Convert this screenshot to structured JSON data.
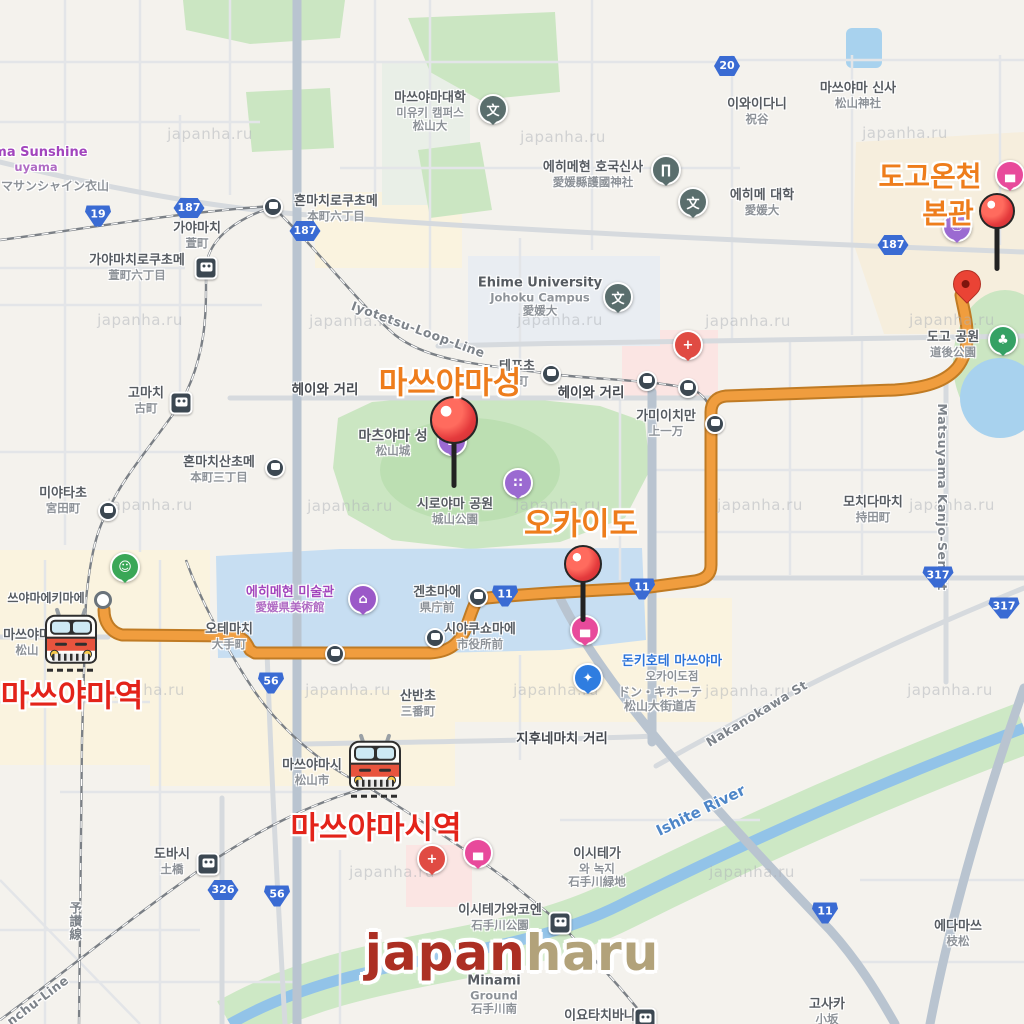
{
  "watermark": {
    "text": "japanha.ru",
    "positions": [
      [
        210,
        134
      ],
      [
        563,
        137
      ],
      [
        905,
        133
      ],
      [
        140,
        320
      ],
      [
        352,
        321
      ],
      [
        560,
        320
      ],
      [
        748,
        321
      ],
      [
        952,
        320
      ],
      [
        150,
        505
      ],
      [
        350,
        506
      ],
      [
        558,
        505
      ],
      [
        760,
        505
      ],
      [
        952,
        505
      ],
      [
        142,
        690
      ],
      [
        348,
        690
      ],
      [
        556,
        690
      ],
      [
        748,
        691
      ],
      [
        950,
        690
      ],
      [
        392,
        872
      ],
      [
        752,
        872
      ]
    ]
  },
  "logo": {
    "part1": "japan",
    "part2": "haru",
    "color1": "#AC2F23",
    "color2": "#B2A27A"
  },
  "colors": {
    "route": "#f09d3e",
    "route_edge": "#c07b24",
    "title_orange": "#ee7d1c",
    "title_red": "#e3231a",
    "shield_blue": "#3a6bd3"
  },
  "highlights": [
    {
      "t": "마쓰야마성",
      "x": 450,
      "y": 380,
      "s": 31,
      "c": "o"
    },
    {
      "t": "오카이도",
      "x": 581,
      "y": 521,
      "s": 31,
      "c": "o"
    },
    {
      "t": "도고온천",
      "x": 930,
      "y": 175,
      "s": 28,
      "c": "o"
    },
    {
      "t": "본관",
      "x": 948,
      "y": 212,
      "s": 28,
      "c": "o"
    },
    {
      "t": "마쓰야마역",
      "x": 72,
      "y": 693,
      "s": 31,
      "c": "r"
    },
    {
      "t": "마쓰야마시역",
      "x": 376,
      "y": 825,
      "s": 31,
      "c": "r"
    }
  ],
  "labels": [
    {
      "t": [
        "가야마치",
        "萱町"
      ],
      "x": 197,
      "y": 236
    },
    {
      "t": [
        "가야마치로쿠초메",
        "萱町六丁目"
      ],
      "x": 137,
      "y": 268
    },
    {
      "t": [
        "혼마치로쿠초메",
        "本町六丁目"
      ],
      "x": 336,
      "y": 209
    },
    {
      "t": [
        "마쓰야마대학",
        "미유키 캠퍼스",
        "松山大"
      ],
      "x": 430,
      "y": 112
    },
    {
      "t": [
        "에히메현 호국신사",
        "愛媛縣護國神社"
      ],
      "x": 593,
      "y": 175
    },
    {
      "t": [
        "이와이다니",
        "祝谷"
      ],
      "x": 757,
      "y": 112
    },
    {
      "t": [
        "마쓰야마 신사",
        "松山神社"
      ],
      "x": 858,
      "y": 96
    },
    {
      "t": [
        "Ehime University",
        "Johoku Campus",
        "愛媛大"
      ],
      "x": 540,
      "y": 297
    },
    {
      "t": [
        "에히메 대학",
        "愛媛大"
      ],
      "x": 762,
      "y": 203
    },
    {
      "t": [
        "테포초",
        "砲町"
      ],
      "x": 517,
      "y": 374
    },
    {
      "t": [
        "헤이와 거리"
      ],
      "x": 325,
      "y": 391,
      "c": "st"
    },
    {
      "t": [
        "헤이와 거리"
      ],
      "x": 591,
      "y": 394,
      "c": "st"
    },
    {
      "t": [
        "가미이치만",
        "上一万"
      ],
      "x": 666,
      "y": 424
    },
    {
      "t": [
        "고마치",
        "古町"
      ],
      "x": 146,
      "y": 401
    },
    {
      "t": [
        "혼마치산초메",
        "本町三丁目"
      ],
      "x": 219,
      "y": 470
    },
    {
      "t": [
        "미야타초",
        "宮田町"
      ],
      "x": 63,
      "y": 501
    },
    {
      "t": [
        "모치다마치",
        "持田町"
      ],
      "x": 873,
      "y": 510
    },
    {
      "t": [
        "도고 공원",
        "道後公園"
      ],
      "x": 953,
      "y": 345
    },
    {
      "t": [
        "시로야마 공원",
        "城山公園"
      ],
      "x": 455,
      "y": 512
    },
    {
      "t": [
        "겐초마에",
        "県庁前"
      ],
      "x": 437,
      "y": 600
    },
    {
      "t": [
        "오테마치",
        "大手町"
      ],
      "x": 229,
      "y": 637
    },
    {
      "t": [
        "시야쿠쇼마에",
        "市役所前"
      ],
      "x": 480,
      "y": 637
    },
    {
      "t": [
        "쓰야마에키마에"
      ],
      "x": 46,
      "y": 599,
      "s": 12
    },
    {
      "t": [
        "마쓰야마",
        "松山"
      ],
      "x": 27,
      "y": 643
    },
    {
      "t": [
        "마쓰야마시",
        "松山市"
      ],
      "x": 312,
      "y": 773
    },
    {
      "t": [
        "산반초",
        "三番町"
      ],
      "x": 418,
      "y": 704
    },
    {
      "t": [
        "지후네마치 거리"
      ],
      "x": 562,
      "y": 740,
      "c": "st"
    },
    {
      "t": [
        "이시테가",
        "와 녹지",
        "石手川緑地"
      ],
      "x": 597,
      "y": 868
    },
    {
      "t": [
        "이시테가와코엔",
        "石手川公園"
      ],
      "x": 500,
      "y": 918
    },
    {
      "t": [
        "도바시",
        "土橋"
      ],
      "x": 172,
      "y": 862
    },
    {
      "t": [
        "에다마쓰",
        "枝松"
      ],
      "x": 958,
      "y": 934
    },
    {
      "t": [
        "고사카",
        "小坂"
      ],
      "x": 827,
      "y": 1012
    },
    {
      "t": [
        "Minami",
        "Ground",
        "石手川南"
      ],
      "x": 494,
      "y": 995
    },
    {
      "t": [
        "이요타치바나"
      ],
      "x": 600,
      "y": 1017
    },
    {
      "t": [
        "마츠야마 성",
        "松山城"
      ],
      "x": 393,
      "y": 443,
      "s": 14
    },
    {
      "t": [
        "ema Sunshine",
        "uyama"
      ],
      "x": 36,
      "y": 160,
      "c": "pu"
    },
    {
      "t": [
        "マサンシャイン衣山"
      ],
      "x": 55,
      "y": 187,
      "c": "g2"
    },
    {
      "t": [
        "에히메현 미술관",
        "愛媛県美術館"
      ],
      "x": 290,
      "y": 600,
      "c": "pu"
    },
    {
      "t": [
        "돈키호테 마쓰야마",
        "오카이도점"
      ],
      "x": 672,
      "y": 669,
      "c": "bl"
    },
    {
      "t": [
        "ドン・キホーテ",
        "松山大街道店"
      ],
      "x": 660,
      "y": 700,
      "c": "g2"
    },
    {
      "t": [
        "Iyotetsu-Loop-Line"
      ],
      "x": 418,
      "y": 330,
      "c": "rot",
      "r": 20
    },
    {
      "t": [
        "Matsuyama Kanjo-Sen St"
      ],
      "x": 942,
      "y": 497,
      "c": "rot",
      "r": 90
    },
    {
      "t": [
        "Nakanokawa St"
      ],
      "x": 757,
      "y": 714,
      "c": "rot",
      "r": -31
    },
    {
      "t": [
        "Ishite River"
      ],
      "x": 701,
      "y": 811,
      "c": "wt",
      "r": -26
    },
    {
      "t": [
        "予讃線"
      ],
      "x": 74,
      "y": 921,
      "c": "rot",
      "v": true
    },
    {
      "t": [
        "nchu-Line"
      ],
      "x": 38,
      "y": 1001,
      "c": "rot",
      "r": -37
    }
  ],
  "shields": [
    {
      "n": "19",
      "t": "n",
      "x": 98,
      "y": 216
    },
    {
      "n": "187",
      "t": "p",
      "x": 189,
      "y": 208
    },
    {
      "n": "187",
      "t": "p",
      "x": 305,
      "y": 231
    },
    {
      "n": "187",
      "t": "p",
      "x": 893,
      "y": 245
    },
    {
      "n": "20",
      "t": "p",
      "x": 727,
      "y": 66
    },
    {
      "n": "56",
      "t": "n",
      "x": 271,
      "y": 683
    },
    {
      "n": "56",
      "t": "n",
      "x": 277,
      "y": 896
    },
    {
      "n": "326",
      "t": "p",
      "x": 223,
      "y": 890
    },
    {
      "n": "11",
      "t": "n",
      "x": 505,
      "y": 596
    },
    {
      "n": "11",
      "t": "n",
      "x": 642,
      "y": 589
    },
    {
      "n": "11",
      "t": "n",
      "x": 825,
      "y": 913
    },
    {
      "n": "317",
      "t": "n",
      "x": 938,
      "y": 577
    },
    {
      "n": "317",
      "t": "n",
      "x": 1004,
      "y": 608
    }
  ],
  "tram_stops": [
    [
      273,
      207
    ],
    [
      551,
      374
    ],
    [
      647,
      381
    ],
    [
      688,
      388
    ],
    [
      715,
      424
    ],
    [
      108,
      511
    ],
    [
      275,
      468
    ],
    [
      478,
      597
    ],
    [
      335,
      654
    ],
    [
      435,
      638
    ]
  ],
  "stations": [
    [
      206,
      268
    ],
    [
      181,
      403
    ],
    [
      208,
      864
    ],
    [
      560,
      923
    ],
    [
      645,
      1019
    ]
  ],
  "simple_stops": [
    [
      103,
      600
    ]
  ],
  "poi": {
    "styles": {
      "school": {
        "bg": "#5a6e6d",
        "glyph": "文"
      },
      "shrine": {
        "bg": "#5a6e6d",
        "glyph": "∏"
      },
      "hospital": {
        "bg": "#e04b43",
        "glyph": "+"
      },
      "museum": {
        "bg": "#9b59c8",
        "glyph": "⌂"
      },
      "castle": {
        "bg": "#9b6ad1",
        "glyph": "⌂"
      },
      "dots": {
        "bg": "#9b6ad1",
        "glyph": "∷"
      },
      "onsen": {
        "bg": "#9b6ad1",
        "glyph": "♨"
      },
      "hotel": {
        "bg": "#e84a9b",
        "glyph": "▄"
      },
      "shopping": {
        "bg": "#2f7de0",
        "glyph": "✦"
      },
      "park": {
        "bg": "#35a164",
        "glyph": "♣"
      },
      "store": {
        "bg": "#3aa757",
        "glyph": "☺"
      }
    },
    "items": [
      {
        "kind": "school",
        "x": 493,
        "y": 109
      },
      {
        "kind": "school",
        "x": 618,
        "y": 297
      },
      {
        "kind": "school",
        "x": 693,
        "y": 202
      },
      {
        "kind": "shrine",
        "x": 666,
        "y": 170
      },
      {
        "kind": "hospital",
        "x": 688,
        "y": 345
      },
      {
        "kind": "hospital",
        "x": 432,
        "y": 859
      },
      {
        "kind": "museum",
        "x": 363,
        "y": 599
      },
      {
        "kind": "castle",
        "x": 452,
        "y": 441
      },
      {
        "kind": "dots",
        "x": 518,
        "y": 483
      },
      {
        "kind": "onsen",
        "x": 957,
        "y": 227
      },
      {
        "kind": "hotel",
        "x": 1010,
        "y": 175
      },
      {
        "kind": "hotel",
        "x": 585,
        "y": 630
      },
      {
        "kind": "hotel",
        "x": 478,
        "y": 853
      },
      {
        "kind": "shopping",
        "x": 588,
        "y": 678
      },
      {
        "kind": "park",
        "x": 1003,
        "y": 340
      },
      {
        "kind": "store",
        "x": 125,
        "y": 567
      }
    ]
  },
  "pins": {
    "ball": [
      {
        "x": 454,
        "y": 418,
        "r": 22,
        "stick": 48
      },
      {
        "x": 583,
        "y": 562,
        "r": 17,
        "stick": 43
      },
      {
        "x": 997,
        "y": 209,
        "r": 16,
        "stick": 46
      }
    ],
    "drop": [
      [
        967,
        298
      ]
    ]
  },
  "trains": [
    [
      71,
      641
    ],
    [
      375,
      767
    ]
  ]
}
